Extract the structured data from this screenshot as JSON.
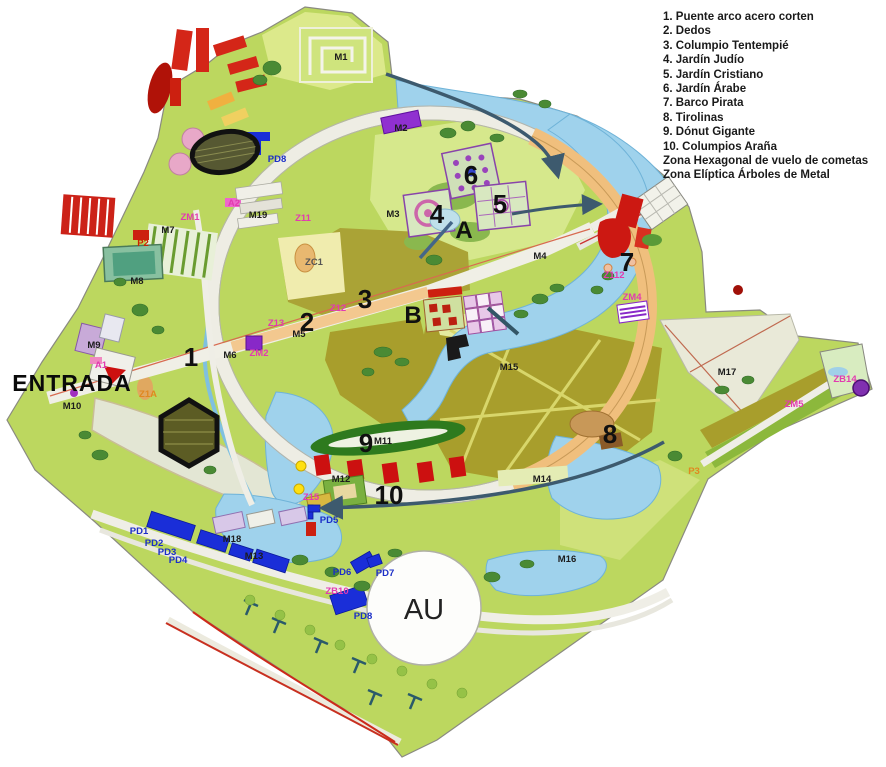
{
  "legend": {
    "items": [
      "1. Puente arco acero corten",
      "2. Dedos",
      "3. Columpio Tentempié",
      "4. Jardín Judío",
      "5. Jardín Cristiano",
      "6. Jardín Árabe",
      "7. Barco Pirata",
      "8. Tirolinas",
      "9. Dónut Gigante",
      "10. Columpios Araña",
      "Zona Hexagonal de vuelo de cometas",
      "Zona Elíptica Árboles de Metal"
    ]
  },
  "map": {
    "palette": {
      "grass": "#bcd75f",
      "pale_grass": "#dce98b",
      "olive_field": "#a89e2c",
      "water": "#9fd2ec",
      "path": "#efeee6",
      "promenade_orange": "#f3c88f",
      "building_red": "#cc1812",
      "parking_blue": "#1a2ed8",
      "zone_pink": "#e23bb0",
      "annotation_dark": "#3d5a6e"
    },
    "labels": [
      {
        "text": "1",
        "x": 191,
        "y": 366,
        "cls": "num"
      },
      {
        "text": "2",
        "x": 307,
        "y": 331,
        "cls": "num"
      },
      {
        "text": "3",
        "x": 365,
        "y": 308,
        "cls": "num"
      },
      {
        "text": "4",
        "x": 437,
        "y": 223,
        "cls": "num"
      },
      {
        "text": "5",
        "x": 500,
        "y": 213,
        "cls": "num"
      },
      {
        "text": "6",
        "x": 471,
        "y": 184,
        "cls": "num"
      },
      {
        "text": "7",
        "x": 627,
        "y": 271,
        "cls": "num"
      },
      {
        "text": "8",
        "x": 610,
        "y": 443,
        "cls": "num"
      },
      {
        "text": "9",
        "x": 366,
        "y": 452,
        "cls": "num"
      },
      {
        "text": "10",
        "x": 389,
        "y": 504,
        "cls": "num"
      },
      {
        "text": "A",
        "x": 464,
        "y": 238,
        "cls": "letter"
      },
      {
        "text": "B",
        "x": 413,
        "y": 323,
        "cls": "letter"
      },
      {
        "text": "AU",
        "x": 424,
        "y": 619,
        "cls": "letter-big"
      },
      {
        "text": "ENTRADA",
        "x": 72,
        "y": 391,
        "cls": "entrada"
      },
      {
        "text": "M1",
        "x": 341,
        "y": 60,
        "cls": "m"
      },
      {
        "text": "M2",
        "x": 401,
        "y": 131,
        "cls": "m"
      },
      {
        "text": "M3",
        "x": 393,
        "y": 217,
        "cls": "m"
      },
      {
        "text": "M4",
        "x": 540,
        "y": 259,
        "cls": "m"
      },
      {
        "text": "M5",
        "x": 299,
        "y": 337,
        "cls": "m"
      },
      {
        "text": "M6",
        "x": 230,
        "y": 358,
        "cls": "m"
      },
      {
        "text": "M7",
        "x": 168,
        "y": 233,
        "cls": "m"
      },
      {
        "text": "M8",
        "x": 137,
        "y": 284,
        "cls": "m"
      },
      {
        "text": "M9",
        "x": 94,
        "y": 348,
        "cls": "m"
      },
      {
        "text": "M10",
        "x": 72,
        "y": 409,
        "cls": "m"
      },
      {
        "text": "M11",
        "x": 383,
        "y": 444,
        "cls": "m"
      },
      {
        "text": "M12",
        "x": 341,
        "y": 482,
        "cls": "m"
      },
      {
        "text": "M13",
        "x": 254,
        "y": 559,
        "cls": "m"
      },
      {
        "text": "M14",
        "x": 542,
        "y": 482,
        "cls": "m"
      },
      {
        "text": "M15",
        "x": 509,
        "y": 370,
        "cls": "m"
      },
      {
        "text": "M16",
        "x": 567,
        "y": 562,
        "cls": "m"
      },
      {
        "text": "M17",
        "x": 727,
        "y": 375,
        "cls": "m"
      },
      {
        "text": "M18",
        "x": 232,
        "y": 542,
        "cls": "m"
      },
      {
        "text": "M19",
        "x": 258,
        "y": 218,
        "cls": "m"
      },
      {
        "text": "PD1",
        "x": 139,
        "y": 534,
        "cls": "pd"
      },
      {
        "text": "PD2",
        "x": 154,
        "y": 546,
        "cls": "pd"
      },
      {
        "text": "PD3",
        "x": 167,
        "y": 555,
        "cls": "pd"
      },
      {
        "text": "PD4",
        "x": 178,
        "y": 563,
        "cls": "pd"
      },
      {
        "text": "PD5",
        "x": 329,
        "y": 523,
        "cls": "pd"
      },
      {
        "text": "PD6",
        "x": 342,
        "y": 575,
        "cls": "pd"
      },
      {
        "text": "PD7",
        "x": 385,
        "y": 576,
        "cls": "pd"
      },
      {
        "text": "PD8",
        "x": 363,
        "y": 619,
        "cls": "pd"
      },
      {
        "text": "PD8",
        "x": 277,
        "y": 162,
        "cls": "pd"
      },
      {
        "text": "ZM1",
        "x": 190,
        "y": 220,
        "cls": "pink"
      },
      {
        "text": "ZM2",
        "x": 259,
        "y": 356,
        "cls": "pink"
      },
      {
        "text": "ZM4",
        "x": 632,
        "y": 300,
        "cls": "pink"
      },
      {
        "text": "ZM5",
        "x": 794,
        "y": 407,
        "cls": "pink"
      },
      {
        "text": "ZB14",
        "x": 845,
        "y": 382,
        "cls": "pink"
      },
      {
        "text": "Z11",
        "x": 303,
        "y": 221,
        "cls": "pink"
      },
      {
        "text": "Z12",
        "x": 338,
        "y": 311,
        "cls": "pink"
      },
      {
        "text": "Z13",
        "x": 276,
        "y": 326,
        "cls": "pink"
      },
      {
        "text": "Z15",
        "x": 311,
        "y": 500,
        "cls": "pink"
      },
      {
        "text": "Z112",
        "x": 614,
        "y": 278,
        "cls": "pink"
      },
      {
        "text": "A1",
        "x": 101,
        "y": 368,
        "cls": "pink"
      },
      {
        "text": "A2",
        "x": 234,
        "y": 206,
        "cls": "pink"
      },
      {
        "text": "ZB10",
        "x": 337,
        "y": 594,
        "cls": "pink"
      },
      {
        "text": "P2",
        "x": 143,
        "y": 246,
        "cls": "red"
      },
      {
        "text": "P3",
        "x": 694,
        "y": 474,
        "cls": "orange"
      },
      {
        "text": "Z1A",
        "x": 148,
        "y": 397,
        "cls": "orange"
      },
      {
        "text": "ZC1",
        "x": 314,
        "y": 265,
        "cls": "gray"
      }
    ]
  }
}
